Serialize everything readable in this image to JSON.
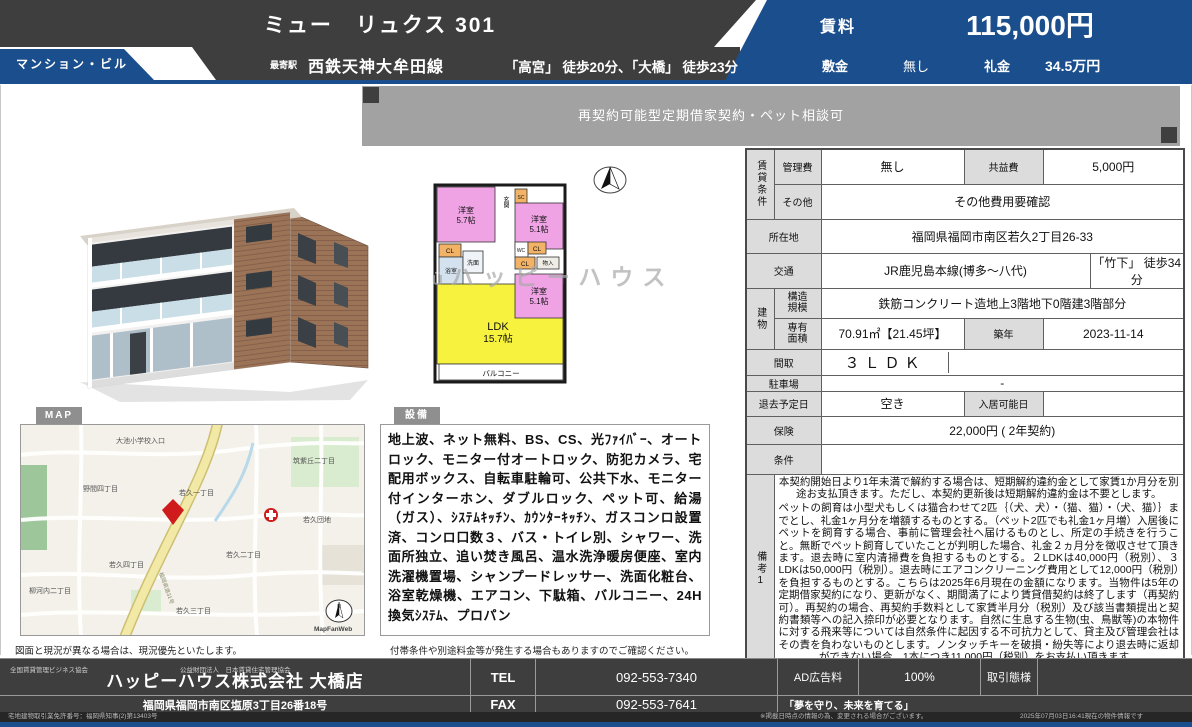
{
  "header": {
    "title": "ミュー　リュクス 301",
    "badge": "マンション・ビル",
    "station_label": "最寄駅",
    "station_line": "西鉄天神大牟田線",
    "station_walk": "「高宮」 徒歩20分、「大橋」 徒歩23分",
    "rent_label": "賃料",
    "rent_value": "115,000円",
    "deposit_label": "敷金",
    "deposit_value": "無し",
    "key_label": "礼金",
    "key_value": "34.5万円"
  },
  "banner": {
    "text": "再契約可能型定期借家契約・ペット相談可"
  },
  "watermark": {
    "mark": "Ü",
    "text": "ハッピーハウス"
  },
  "plan": {
    "room_a": "洋室",
    "room_a_size": "5.7帖",
    "room_b": "洋室",
    "room_b_size": "5.1帖",
    "room_c": "洋室",
    "room_c_size": "5.1帖",
    "ldk": "LDK",
    "ldk_size": "15.7帖",
    "balcony": "バルコニー",
    "entrance": "玄関",
    "cl": "CL",
    "sc": "SC",
    "wc": "WC",
    "bath": "浴室",
    "wash": "洗面",
    "storage": "物入",
    "compass_n": "N"
  },
  "details": {
    "group_rental": "賃貸条件",
    "group_building": "建物",
    "kanrihi": {
      "label": "管理費",
      "value": "無し",
      "label2": "共益費",
      "value2": "5,000円"
    },
    "sonota": {
      "label": "その他",
      "value": "その他費用要確認"
    },
    "shozaichi": {
      "label": "所在地",
      "value": "福岡県福岡市南区若久2丁目26-33"
    },
    "kotsu": {
      "label": "交通",
      "value": "JR鹿児島本線(博多〜八代)",
      "value2": "「竹下」 徒歩34分"
    },
    "kozo": {
      "label": "構造規模",
      "value": "鉄筋コンクリート造地上3階地下0階建3階部分"
    },
    "menseki": {
      "label": "専有面積",
      "value": "70.91㎡【21.45坪】",
      "label2": "築年",
      "value2": "2023-11-14"
    },
    "madori": {
      "label": "間取",
      "value": "３ＬＤＫ"
    },
    "parking": {
      "label": "駐車場",
      "value": "-"
    },
    "taikyo": {
      "label": "退去予定日",
      "value": "空き",
      "label2": "入居可能日",
      "value2": ""
    },
    "hoken": {
      "label": "保険",
      "value": "22,000円 ( 2年契約)"
    },
    "joken": {
      "label": "条件",
      "value": ""
    },
    "biko1": {
      "label": "備考1",
      "p1": "本契約開始日より1年未満で解約する場合は、短期解約違約金として家賃1か月分を別途お支払頂きます。ただし、本契約更新後は短期解約違約金は不要とします。",
      "p2": "ペットの飼育は小型犬もしくは猫合わせて2匹｛（犬、犬）・（猫、猫）・（犬、猫）｝までとし、礼金1ヶ月分を増額するものとする。（ペット2匹でも礼金1ヶ月増）入居後にペットを飼育する場合、事前に管理会社へ届けるものとし、所定の手続きを行うこと。無断でペット飼育していたことが判明した場合、礼金２ヵ月分を徴収させて頂きます。退去時に室内清掃費を負担するものとする。２LDKは40,000円（税別）、３LDKは50,000円（税別）。退去時にエアコンクリーニング費用として12,000円（税別）を負担するものとする。こちらは2025年6月現在の金額になります。当物件は5年の定期借家契約になり、更新がなく、期間満了により賃貸借契約は終了します（再契約可）。再契約の場合、再契約手数料として家賃半月分（税別）及び該当書類提出と契約書類等への記入捺印が必要となります。自然に生息する生物(虫、鳥獣等)の本物件に対する飛来等については自然条件に起因する不可抗力として、貸主及び管理会社はその責を負わないものとします。ノンタッチキーを破損・紛失等により退去時に返却ができない場合、1本につき11,000円（税別）をお支払い頂きます。"
    },
    "biko2": {
      "label": "備考2",
      "value": ""
    }
  },
  "map_section": {
    "badge": "MAP",
    "caption": "図面と現況が異なる場合は、現況優先といたします。",
    "labels": [
      "大池小学校入口",
      "筑紫丘二丁目",
      "野間四丁目",
      "若久一丁目",
      "若久団地",
      "若久二丁目",
      "若久四丁目",
      "柳河内二丁目",
      "若久三丁目"
    ],
    "road_label": "福岡県道31号",
    "credit": "MapFanWeb"
  },
  "equipment": {
    "badge": "設備",
    "text": "地上波、ネット無料、BS、CS、光ﾌｧｲﾊﾞｰ、オートロック、モニター付オートロック、防犯カメラ、宅配用ボックス、自転車駐輪可、公共下水、モニター付インターホン、ダブルロック、ペット可、給湯（ガス）、ｼｽﾃﾑｷｯﾁﾝ、ｶｳﾝﾀｰｷｯﾁﾝ、ガスコンロ設置済、コンロ口数３、バス・トイレ別、シャワー、洗面所独立、追い焚き風呂、温水洗浄暖房便座、室内洗濯機置場、シャンプードレッサー、洗面化粧台、浴室乾燥機、エアコン、下駄箱、バルコニー、24H換気ｼｽﾃﾑ、プロパン",
    "caption": "付帯条件や別途料金等が発生する場合もありますのでご確認ください。"
  },
  "footer": {
    "assoc1": "全国賃貸管理ビジネス協会",
    "assoc2": "公益財団法人　日本賃貸住宅管理協会",
    "company": "ハッピーハウス株式会社 大橋店",
    "address": "福岡県福岡市南区塩原3丁目26番18号",
    "tel_label": "TEL",
    "tel": "092-553-7340",
    "fax_label": "FAX",
    "fax": "092-553-7641",
    "ad_label": "AD広告料",
    "ad_value": "100%",
    "deal_label": "取引態様",
    "deal_value": "",
    "slogan": "「夢を守り、未来を育てる」",
    "license": "宅地建物取引業免許番号：福岡県知事(2)第13403号",
    "note": "※掲載日時点の情報の為、変更される場合がございます。",
    "timestamp": "2025年07月03日16:41現在の物件情報です"
  },
  "colors": {
    "accent_blue": "#1b4e8c",
    "header_dark": "#3e3e3e",
    "banner_gray": "#a2a2a2",
    "plan_pink": "#efa3e4",
    "plan_yellow": "#f6f23d",
    "plan_orange": "#f2b366",
    "map_marker_red": "#cf1b1b"
  }
}
